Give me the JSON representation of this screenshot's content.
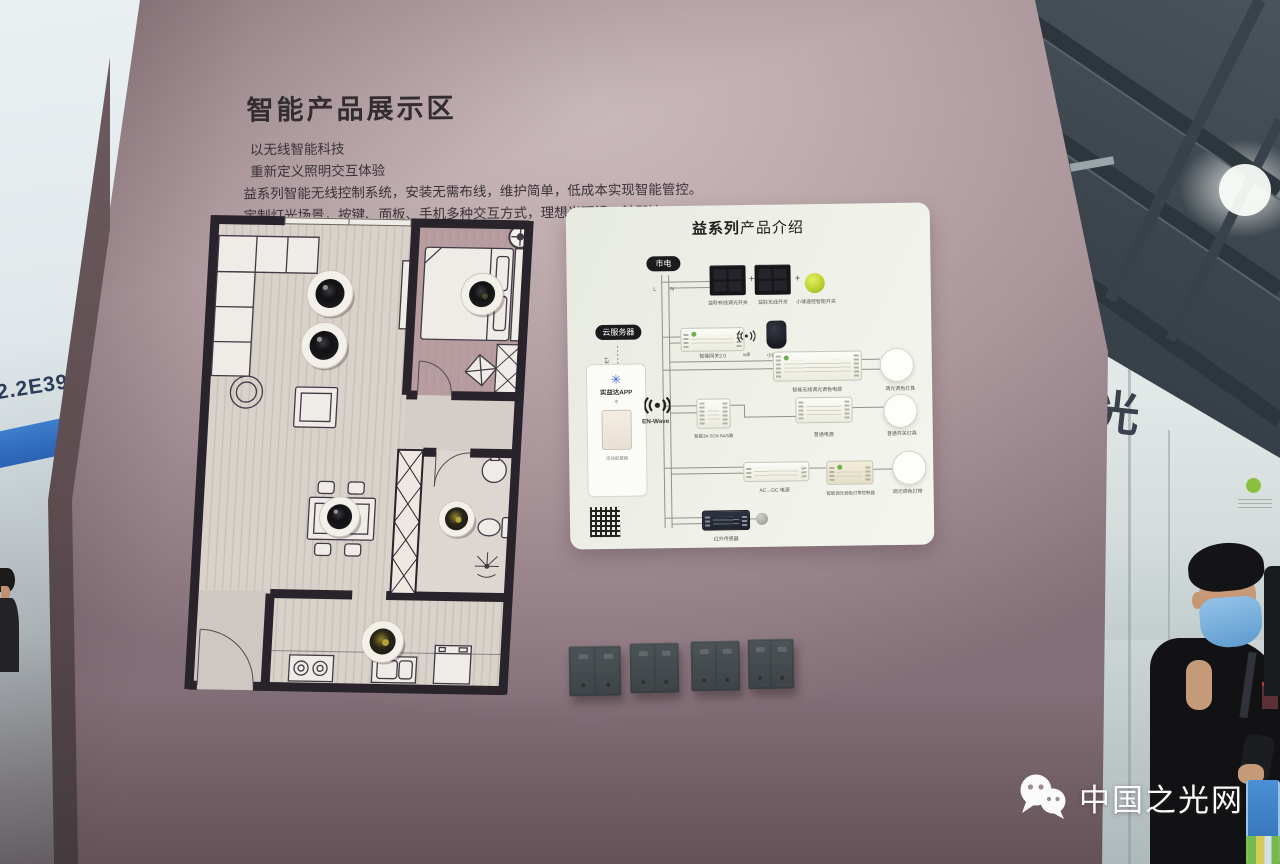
{
  "booth": {
    "number": "2.2E39"
  },
  "headline": {
    "title": "智能产品展示区",
    "lines": [
      "以无线智能科技",
      "重新定义照明交互体验",
      "益系列智能无线控制系统，安装无需布线，维护简单，低成本实现智能管控。",
      "定制灯光场景，按键、面板、手机多种交互方式，理想光环境一触即达。"
    ]
  },
  "panel": {
    "title_strong": "益系列",
    "title_rest": "产品介绍",
    "mains": "市电",
    "cloud": "云服务器",
    "internet": "INTERNET",
    "wire_l": "L",
    "wire_n": "N",
    "plus": "+",
    "switch_labels": [
      "益聆有线调光开关",
      "益聆无线开关",
      "小球遥控智能开关"
    ],
    "gateway": "智能网关2.0",
    "wifi": "wifi",
    "speaker": "小度音箱",
    "app": {
      "name": "实益达APP",
      "caption": "无线配置器"
    },
    "protocol": "EN-Wave",
    "rows": {
      "dim_driver": "智能无线调光调色电源",
      "dim_lamp": "调光调色灯具",
      "relay_module": "智能3A SCN 8A/5路",
      "plain_driver": "普通电源",
      "plain_lamp": "普通开关灯具",
      "acdc": "AC→DC 电源",
      "strip_controller": "智能调光调色灯带控制器",
      "strip_lamp": "调光调色灯带",
      "ir_sensor": "红外传感器"
    }
  },
  "side_wall": {
    "glyph": "光"
  },
  "watermark": {
    "text": "中国之光网",
    "icon": "wechat-icon"
  },
  "floor_plan": {
    "downlight_count": 6
  },
  "switch_wall": {
    "panel_count": 4
  },
  "colors": {
    "wall": "#ab969b",
    "panel_bg": "#eef0e8",
    "accent_ball": "#bdd233",
    "stripe_blue": "#2f6fc1"
  },
  "icons": {
    "wechat": "wechat-icon",
    "wifi": "wifi-signal-icon",
    "enwave": "enwave-signal-icon",
    "qr": "qr-code",
    "compass": "compass-icon",
    "downlight": "downlight-fixture"
  }
}
